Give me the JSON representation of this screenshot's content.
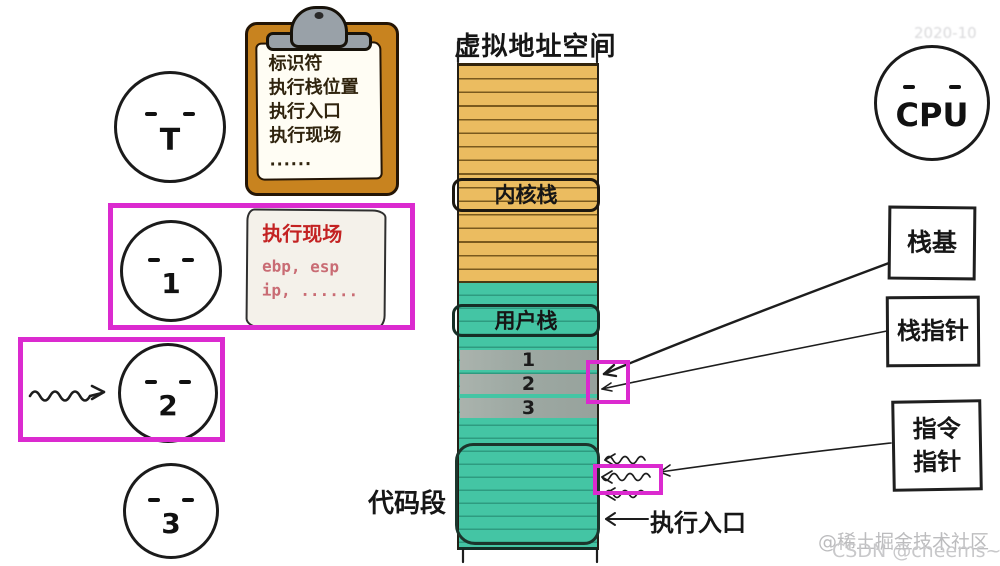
{
  "title": "虚拟地址空间",
  "clipboard": {
    "lines": [
      "标识符",
      "执行栈位置",
      "执行入口",
      "执行现场",
      "......"
    ]
  },
  "faces": {
    "t": "T",
    "one": "1",
    "two": "2",
    "three": "3",
    "cpu": "CPU"
  },
  "note": {
    "title": "执行现场",
    "body1": "ebp, esp",
    "body2": "ip, ......"
  },
  "memory": {
    "kernel_stack": "内核栈",
    "user_stack": "用户栈",
    "frame_rows": [
      "1",
      "2",
      "3"
    ],
    "code_segment_label": "代码段",
    "entry_label": "执行入口"
  },
  "registers": {
    "stack_base": "栈基",
    "stack_pointer": "栈指针",
    "instr_line1": "指令",
    "instr_line2": "指针"
  },
  "watermarks": {
    "top_right": "2020-10",
    "bottom_line1": "@稀土掘金技术社区",
    "bottom_line2": "CSDN @cheems~"
  },
  "colors": {
    "kernel_region": "#EBBC60",
    "user_region": "#44C5A4",
    "frame_row": "#9EA9A3",
    "highlight": "#DB2ACF",
    "clipboard_board": "#C8831F",
    "note_title": "#C32222",
    "note_body": "#C96C74"
  }
}
